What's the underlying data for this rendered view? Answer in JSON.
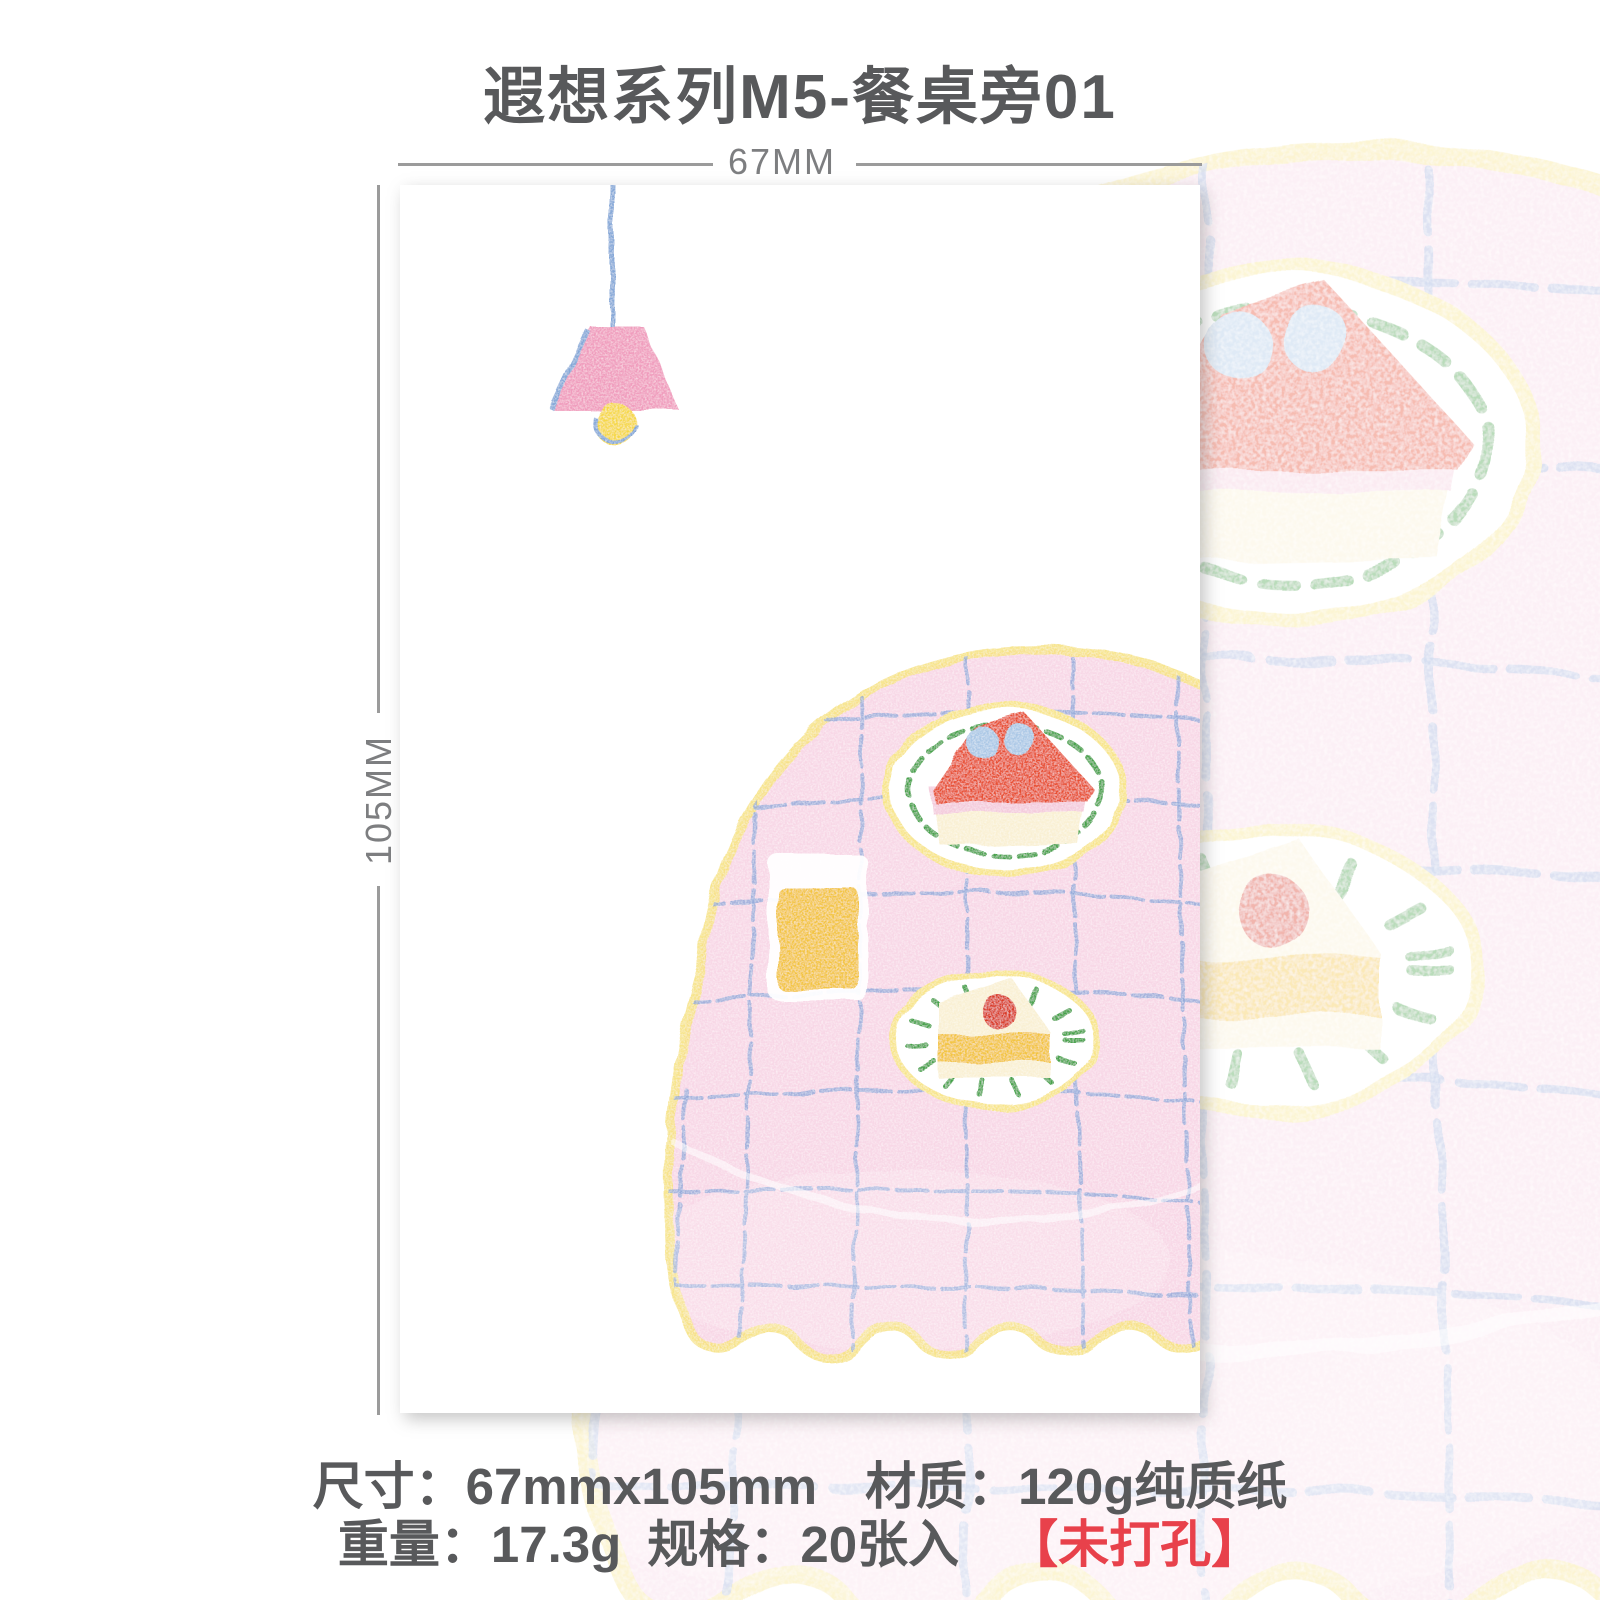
{
  "title": "遐想系列M5-餐桌旁01",
  "dimensions": {
    "width_label": "67MM",
    "height_label": "105MM"
  },
  "specs": {
    "size_label": "尺寸：",
    "size_value": "67mmx105mm",
    "material_label": "材质：",
    "material_value": "120g纯质纸",
    "weight_label": "重量：",
    "weight_value": "17.3g",
    "count_label": "规格：",
    "count_value": "20张入",
    "hole_note": "【未打孔】"
  },
  "palette": {
    "ink": "#58595b",
    "dim-gray": "#9b9b9b",
    "dim-text": "#7d7e80",
    "spec-red": "#e8414b",
    "cloth-pink": "#f8d7e6",
    "edge-yellow": "#f6e27e",
    "grid-blue": "#8ea8da",
    "rim-yellow": "#f8e58a",
    "green": "#44a348",
    "cake-red": "#e84f33",
    "cherry-red": "#da3a28",
    "berry-blue": "#abc8e6",
    "cream": "#f9f0d3",
    "layer-pink": "#f4cbdc",
    "juice-yellow": "#f3c541",
    "lamp-pink": "#f09cbd",
    "bulb-yellow": "#f6d844",
    "cord-blue": "#85a8d8"
  }
}
